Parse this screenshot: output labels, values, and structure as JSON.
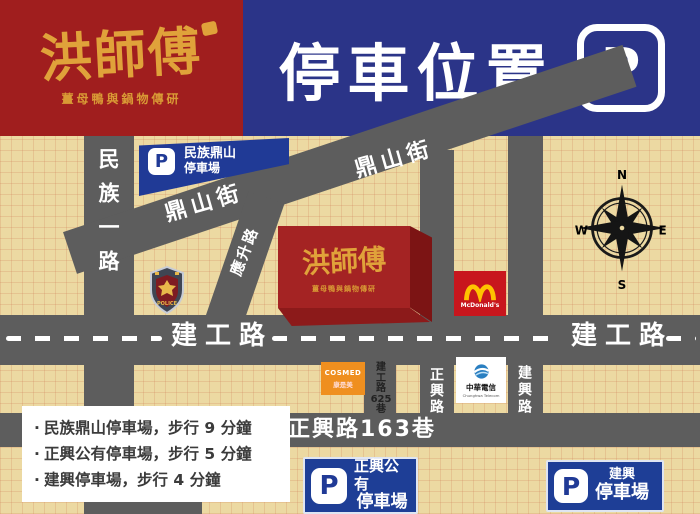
{
  "header": {
    "logo": {
      "title": "洪師傅",
      "subtitle": "薑母鴨與鍋物傳研"
    },
    "title": "停車位置",
    "p_badge": "P"
  },
  "colors": {
    "banner_red": "#a01e1e",
    "banner_blue": "#2b3488",
    "gold": "#e0a23a",
    "map_bg": "#ecd9a2",
    "road_gray": "#5d5d5d",
    "parking_blue": "#1e3e96",
    "building_red": "#a42323",
    "mcdonalds_red": "#c8161d",
    "arches_yellow": "#ffc300",
    "cosmed_orange": "#ef8f1f"
  },
  "map": {
    "roads": {
      "minzu": "民族一路",
      "dingshan_upper": "鼎山街",
      "dingshan_lower": "鼎山街",
      "yingsheng": "應升路",
      "jiangong_left": "建工路",
      "jiangong_right": "建工路",
      "lane625": [
        "建",
        "工",
        "路",
        "625",
        "巷"
      ],
      "zhengxing": "正興路",
      "jianxing": "建興路",
      "lane163": "正興路163巷"
    },
    "compass": {
      "n": "N",
      "e": "E",
      "s": "S",
      "w": "W"
    },
    "pois": {
      "minzu_parking": {
        "p": "P",
        "line1": "民族鼎山",
        "line2": "停車場"
      },
      "police": {
        "label": "POLICE"
      },
      "restaurant": {
        "title": "洪師傅",
        "subtitle": "薑母鴨與鍋物傳研"
      },
      "mcdonalds": {
        "name": "McDonald's"
      },
      "cosmed": {
        "name": "COSMED",
        "zh": "康是美"
      },
      "cht": {
        "zh": "中華電信",
        "en": "Chunghwa Telecom"
      },
      "zhengxing_parking": {
        "p": "P",
        "line1": "正興公有",
        "line2": "停車場"
      },
      "jianxing_parking": {
        "p": "P",
        "line1": "建興",
        "line2": "停車場"
      }
    },
    "legend": {
      "bullet": "‧",
      "items": [
        "民族鼎山停車場，步行 9 分鐘",
        "正興公有停車場，步行 5 分鐘",
        "建興停車場，步行 4 分鐘"
      ]
    }
  }
}
